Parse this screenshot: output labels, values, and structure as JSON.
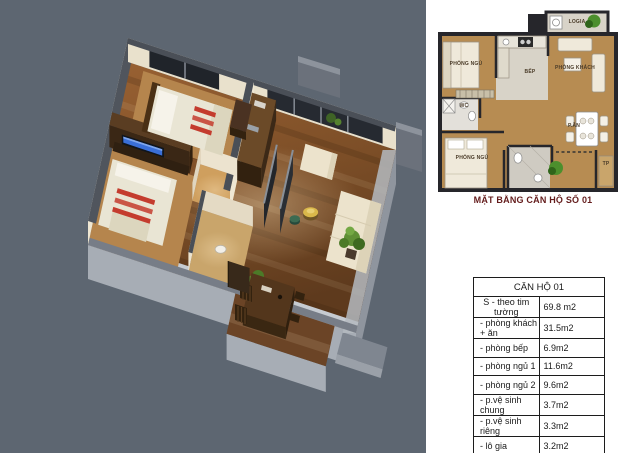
{
  "plan2d": {
    "caption": "MẶT BẰNG CĂN HỘ SỐ 01",
    "rooms": [
      {
        "label": "PHÒNG NGỦ"
      },
      {
        "label": "BẾP"
      },
      {
        "label": "PHÒNG KHÁCH"
      },
      {
        "label": "LOGIA"
      },
      {
        "label": "WC"
      },
      {
        "label": "PHÒNG NGỦ"
      },
      {
        "label": "P.ĂN"
      },
      {
        "label": "TP"
      }
    ]
  },
  "table": {
    "title": "CĂN HỘ 01",
    "rows": [
      {
        "label": "S - theo tim tường",
        "value": "69.8 m2"
      },
      {
        "label": "- phòng khách + ăn",
        "value": "31.5m2"
      },
      {
        "label": "- phòng bếp",
        "value": "6.9m2"
      },
      {
        "label": "- phòng ngủ 1",
        "value": "11.6m2"
      },
      {
        "label": "- phòng ngủ 2",
        "value": "9.6m2"
      },
      {
        "label": "- p.vệ sinh chung",
        "value": "3.7m2"
      },
      {
        "label": "- p.vệ sinh riêng",
        "value": "3.3m2"
      },
      {
        "label": "- lô gia",
        "value": "3.2m2"
      }
    ]
  },
  "colors": {
    "render_background": "#5d6671",
    "caption_text": "#641c1c",
    "concrete_base": "#a7adb5",
    "wood_floor": "#8a5a30",
    "interior_wall": "#efe7d3",
    "wall_top": "#4a4f57",
    "plan_floor_wood": "#b78c52",
    "plan_wall": "#26262b"
  }
}
